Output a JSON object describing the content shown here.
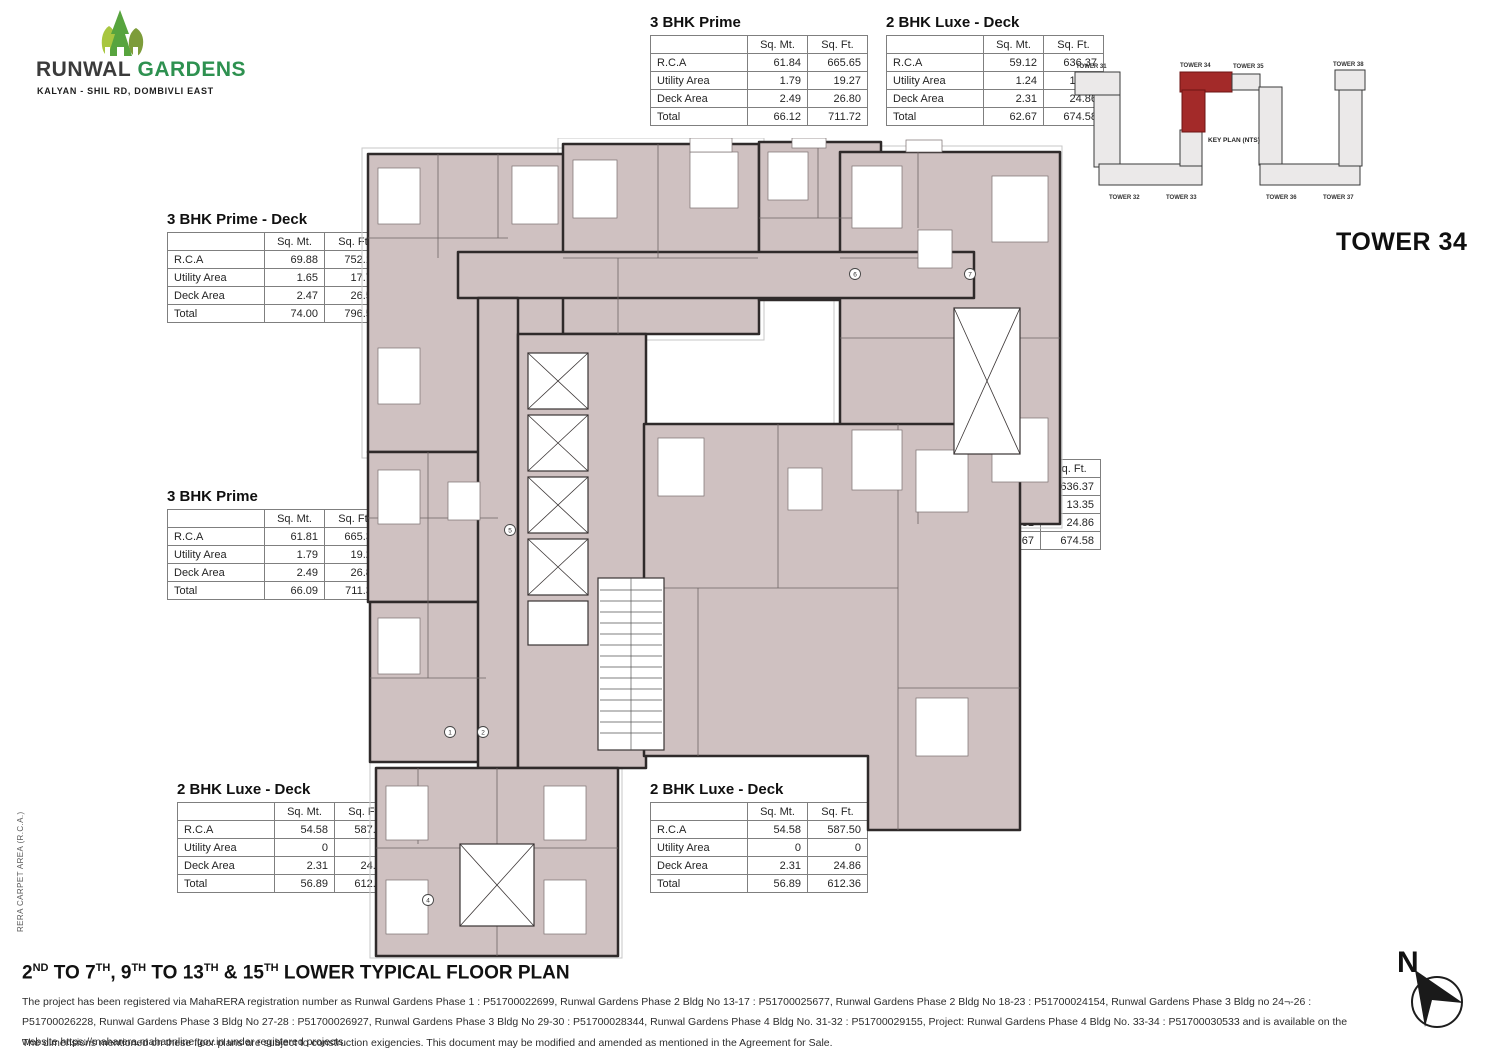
{
  "logo": {
    "brand_primary": "RUNWAL",
    "brand_secondary": "GARDENS",
    "tagline": "KALYAN - SHIL RD, DOMBIVLI EAST",
    "tree_colors": [
      "#a8c63f",
      "#57a43e",
      "#7d9c3a"
    ],
    "brand_green": "#2e9150"
  },
  "tower_title": "TOWER 34",
  "key_plan": {
    "label": "KEY PLAN (NTS)",
    "towers": [
      "TOWER 31",
      "TOWER 34",
      "TOWER 35",
      "TOWER 38",
      "TOWER 32",
      "TOWER 33",
      "TOWER 36",
      "TOWER 37"
    ],
    "highlight_color": "#a32a29",
    "footprint_color": "#ebe9e9"
  },
  "table_headers": {
    "col1": "Sq. Mt.",
    "col2": "Sq. Ft."
  },
  "tables": [
    {
      "title": "3 BHK Prime",
      "rows": [
        [
          "R.C.A",
          "61.84",
          "665.65"
        ],
        [
          "Utility Area",
          "1.79",
          "19.27"
        ],
        [
          "Deck Area",
          "2.49",
          "26.80"
        ],
        [
          "Total",
          "66.12",
          "711.72"
        ]
      ]
    },
    {
      "title": "2 BHK Luxe - Deck",
      "rows": [
        [
          "R.C.A",
          "59.12",
          "636.37"
        ],
        [
          "Utility Area",
          "1.24",
          "13.35"
        ],
        [
          "Deck Area",
          "2.31",
          "24.86"
        ],
        [
          "Total",
          "62.67",
          "674.58"
        ]
      ]
    },
    {
      "title": "3 BHK Prime - Deck",
      "rows": [
        [
          "R.C.A",
          "69.88",
          "752.19"
        ],
        [
          "Utility Area",
          "1.65",
          "17.76"
        ],
        [
          "Deck Area",
          "2.47",
          "26.59"
        ],
        [
          "Total",
          "74.00",
          "796.54"
        ]
      ]
    },
    {
      "title": "3 BHK Prime",
      "rows": [
        [
          "R.C.A",
          "61.81",
          "665.32"
        ],
        [
          "Utility Area",
          "1.79",
          "19.27"
        ],
        [
          "Deck Area",
          "2.49",
          "26.80"
        ],
        [
          "Total",
          "66.09",
          "711.39"
        ]
      ]
    },
    {
      "title": "2 BHK Prime",
      "rows": [
        [
          "R.C.A",
          "45.40",
          "488.69"
        ],
        [
          "Utility Area",
          "0",
          "0"
        ],
        [
          "Deck Area",
          "2.26",
          "24.33"
        ],
        [
          "Total",
          "47.66",
          "513.02"
        ]
      ]
    },
    {
      "title": "2 BHK Luxe - Deck",
      "rows": [
        [
          "R.C.A",
          "59.12",
          "636.37"
        ],
        [
          "Utility Area",
          "1.24",
          "13.35"
        ],
        [
          "Deck Area",
          "2.31",
          "24.86"
        ],
        [
          "Total",
          "62.67",
          "674.58"
        ]
      ]
    },
    {
      "title": "2 BHK Prime - Deck",
      "rows": [
        [
          "R.C.A",
          "52.11",
          "560.91"
        ],
        [
          "Utility Area",
          "0",
          "0"
        ],
        [
          "Deck Area",
          "2.52",
          "27.13"
        ],
        [
          "Total",
          "54.63",
          "588.04"
        ]
      ]
    },
    {
      "title": "2 BHK Luxe - Deck",
      "rows": [
        [
          "R.C.A",
          "54.58",
          "587.50"
        ],
        [
          "Utility Area",
          "0",
          "0"
        ],
        [
          "Deck Area",
          "2.31",
          "24.86"
        ],
        [
          "Total",
          "56.89",
          "612.36"
        ]
      ]
    },
    {
      "title": "2 BHK Luxe - Deck",
      "rows": [
        [
          "R.C.A",
          "54.58",
          "587.50"
        ],
        [
          "Utility Area",
          "0",
          "0"
        ],
        [
          "Deck Area",
          "2.31",
          "24.86"
        ],
        [
          "Total",
          "56.89",
          "612.36"
        ]
      ]
    }
  ],
  "floor_plan": {
    "room_fill": "#cfc1c1",
    "wall_color": "#2f2a2a",
    "markers": [
      {
        "x": 497,
        "y": 136,
        "label": "6"
      },
      {
        "x": 612,
        "y": 136,
        "label": "7"
      },
      {
        "x": 152,
        "y": 392,
        "label": "5"
      },
      {
        "x": 92,
        "y": 594,
        "label": "1"
      },
      {
        "x": 125,
        "y": 594,
        "label": "2"
      },
      {
        "x": 70,
        "y": 762,
        "label": "4"
      }
    ]
  },
  "main_title": {
    "plain": "2ND TO 7TH, 9TH TO 13TH & 15TH LOWER TYPICAL FLOOR PLAN",
    "segments": [
      {
        "t": "2",
        "sup": false
      },
      {
        "t": "ND",
        "sup": true
      },
      {
        "t": " TO 7",
        "sup": false
      },
      {
        "t": "TH",
        "sup": true
      },
      {
        "t": ", 9",
        "sup": false
      },
      {
        "t": "TH",
        "sup": true
      },
      {
        "t": " TO 13",
        "sup": false
      },
      {
        "t": "TH",
        "sup": true
      },
      {
        "t": " & 15",
        "sup": false
      },
      {
        "t": "TH",
        "sup": true
      },
      {
        "t": " LOWER TYPICAL FLOOR PLAN",
        "sup": false
      }
    ]
  },
  "footer": {
    "registration": "The project has been registered via MahaRERA registration number as Runwal Gardens Phase 1 : P51700022699, Runwal Gardens Phase 2 Bldg No 13-17 : P51700025677, Runwal Gardens Phase 2 Bldg No 18-23 : P51700024154, Runwal Gardens Phase 3 Bldg no 24¬-26 : P51700026228, Runwal Gardens Phase 3 Bldg No 27-28 : P51700026927,  Runwal Gardens Phase 3 Bldg No 29-30 : P51700028344, Runwal Gardens Phase 4 Bldg No. 31-32 : P51700029155, Project: Runwal Gardens Phase 4 Bldg No. 33-34 : P51700030533  and is available on the website https://maharera.mahaonline.gov.in under registered projects.",
    "disclaimer": "The dimensions mentioned on these floor plans are subject to construction exigencies. This document may be modified and amended as mentioned in the Agreement for Sale."
  },
  "side_note": "RERA CARPET AREA (R.C.A.)",
  "compass": {
    "label": "N"
  }
}
